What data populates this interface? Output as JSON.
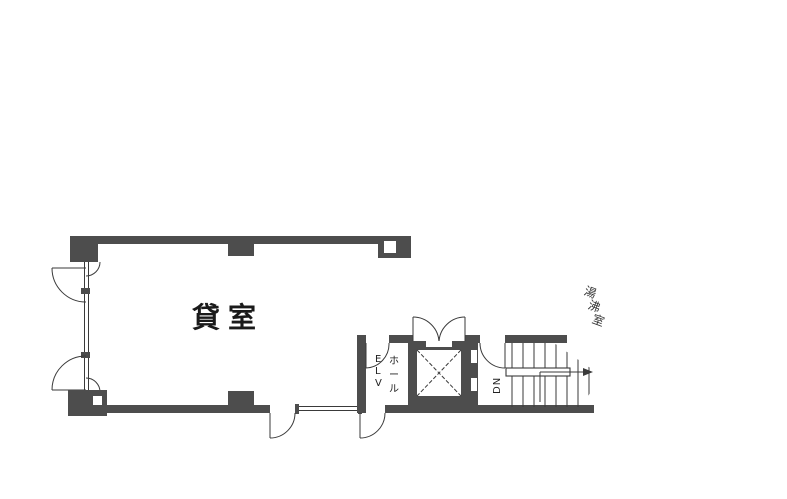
{
  "colors": {
    "wall": "#4d4d4d",
    "line": "#3a3a3a",
    "shade": "#e9e9e9",
    "shade2": "#e2e2e2",
    "shade3": "#f0f0f0",
    "text": "#1a1a1a"
  },
  "labels": {
    "main_room": "貸室",
    "balcony": "バルコニー",
    "elv": [
      "E",
      "L",
      "V"
    ],
    "elv_hall": [
      "ホ",
      "ー",
      "ル"
    ],
    "stairs_down": "DN",
    "kitchenette": [
      "湯",
      "沸",
      "室"
    ]
  }
}
